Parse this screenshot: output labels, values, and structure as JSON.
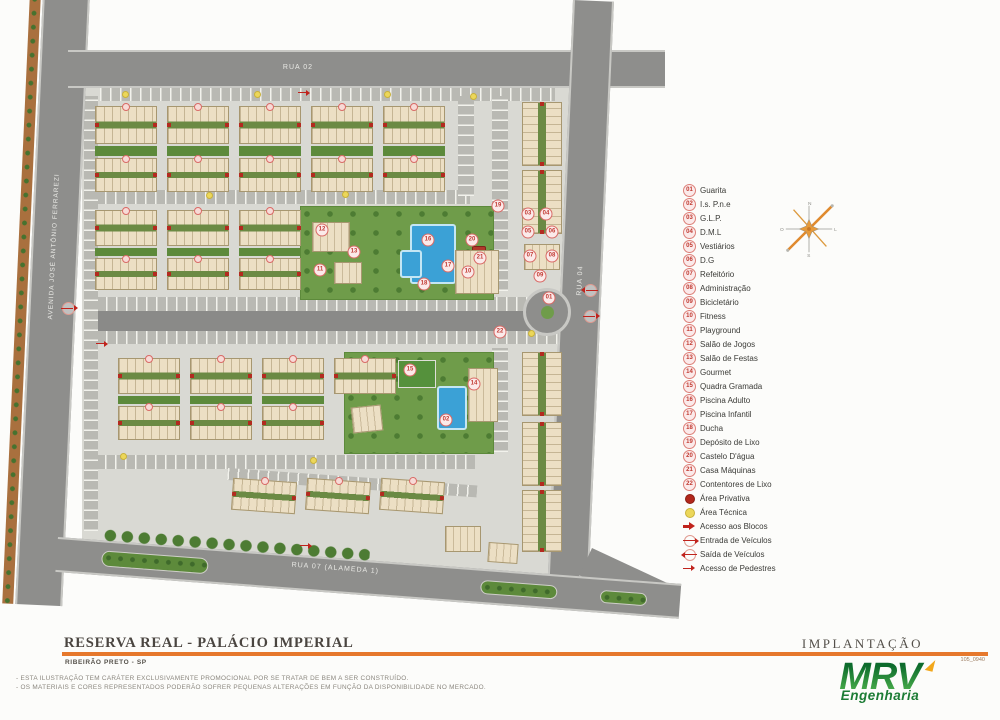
{
  "plan": {
    "streets": {
      "top": "RUA 02",
      "left": "AVENIDA JOSÉ ANTÔNIO FERRAREZI",
      "right": "RUA 04",
      "bottom": "RUA 07 (ALAMEDA 1)"
    },
    "compass": {
      "n": "N",
      "s": "S",
      "e": "L",
      "w": "O"
    }
  },
  "legend": {
    "items": [
      {
        "num": "01",
        "label": "Guarita"
      },
      {
        "num": "02",
        "label": "I.s. P.n.e"
      },
      {
        "num": "03",
        "label": "G.L.P."
      },
      {
        "num": "04",
        "label": "D.M.L"
      },
      {
        "num": "05",
        "label": "Vestiários"
      },
      {
        "num": "06",
        "label": "D.G"
      },
      {
        "num": "07",
        "label": "Refeitório"
      },
      {
        "num": "08",
        "label": "Administração"
      },
      {
        "num": "09",
        "label": "Bicicletário"
      },
      {
        "num": "10",
        "label": "Fitness"
      },
      {
        "num": "11",
        "label": "Playground"
      },
      {
        "num": "12",
        "label": "Salão de Jogos"
      },
      {
        "num": "13",
        "label": "Salão de Festas"
      },
      {
        "num": "14",
        "label": "Gourmet"
      },
      {
        "num": "15",
        "label": "Quadra Gramada"
      },
      {
        "num": "16",
        "label": "Piscina Adulto"
      },
      {
        "num": "17",
        "label": "Piscina Infantil"
      },
      {
        "num": "18",
        "label": "Ducha"
      },
      {
        "num": "19",
        "label": "Depósito de Lixo"
      },
      {
        "num": "20",
        "label": "Castelo D'água"
      },
      {
        "num": "21",
        "label": "Casa Máquinas"
      },
      {
        "num": "22",
        "label": "Contentores de Lixo"
      }
    ],
    "symbols": [
      {
        "icon": "dot-red",
        "label": "Área Privativa"
      },
      {
        "icon": "dot-yellow",
        "label": "Área Técnica"
      },
      {
        "icon": "arrow-bold",
        "label": "Acesso aos Blocos"
      },
      {
        "icon": "circle-arrow-right",
        "label": "Entrada de Veículos"
      },
      {
        "icon": "circle-arrow-left",
        "label": "Saída de Veículos"
      },
      {
        "icon": "arrow-thin",
        "label": "Acesso de Pedestres"
      }
    ]
  },
  "footer": {
    "project_title": "RESERVA REAL - PALÁCIO IMPERIAL",
    "location": "RIBEIRÃO PRETO - SP",
    "sheet_label": "IMPLANTAÇÃO",
    "sheet_code": "105_0940",
    "disclaimer_line1": "- ESTA ILUSTRAÇÃO TEM CARÁTER EXCLUSIVAMENTE PROMOCIONAL POR SE TRATAR DE BEM A SER CONSTRUÍDO.",
    "disclaimer_line2": "- OS MATERIAIS E CORES REPRESENTADOS PODERÃO SOFRER PEQUENAS ALTERAÇÕES EM FUNÇÃO DA DISPONIBILIDADE NO MERCADO.",
    "logo_text": "MRV",
    "logo_subtext": "Engenharia"
  },
  "colors": {
    "accent_orange": "#e6782c",
    "legend_red": "#c0231c",
    "grass_green": "#6f9c4a",
    "pool_blue": "#3ba1d6",
    "road_gray": "#8e8e8c",
    "building_beige": "#ecdfc4",
    "mrv_green": "#157a31"
  }
}
